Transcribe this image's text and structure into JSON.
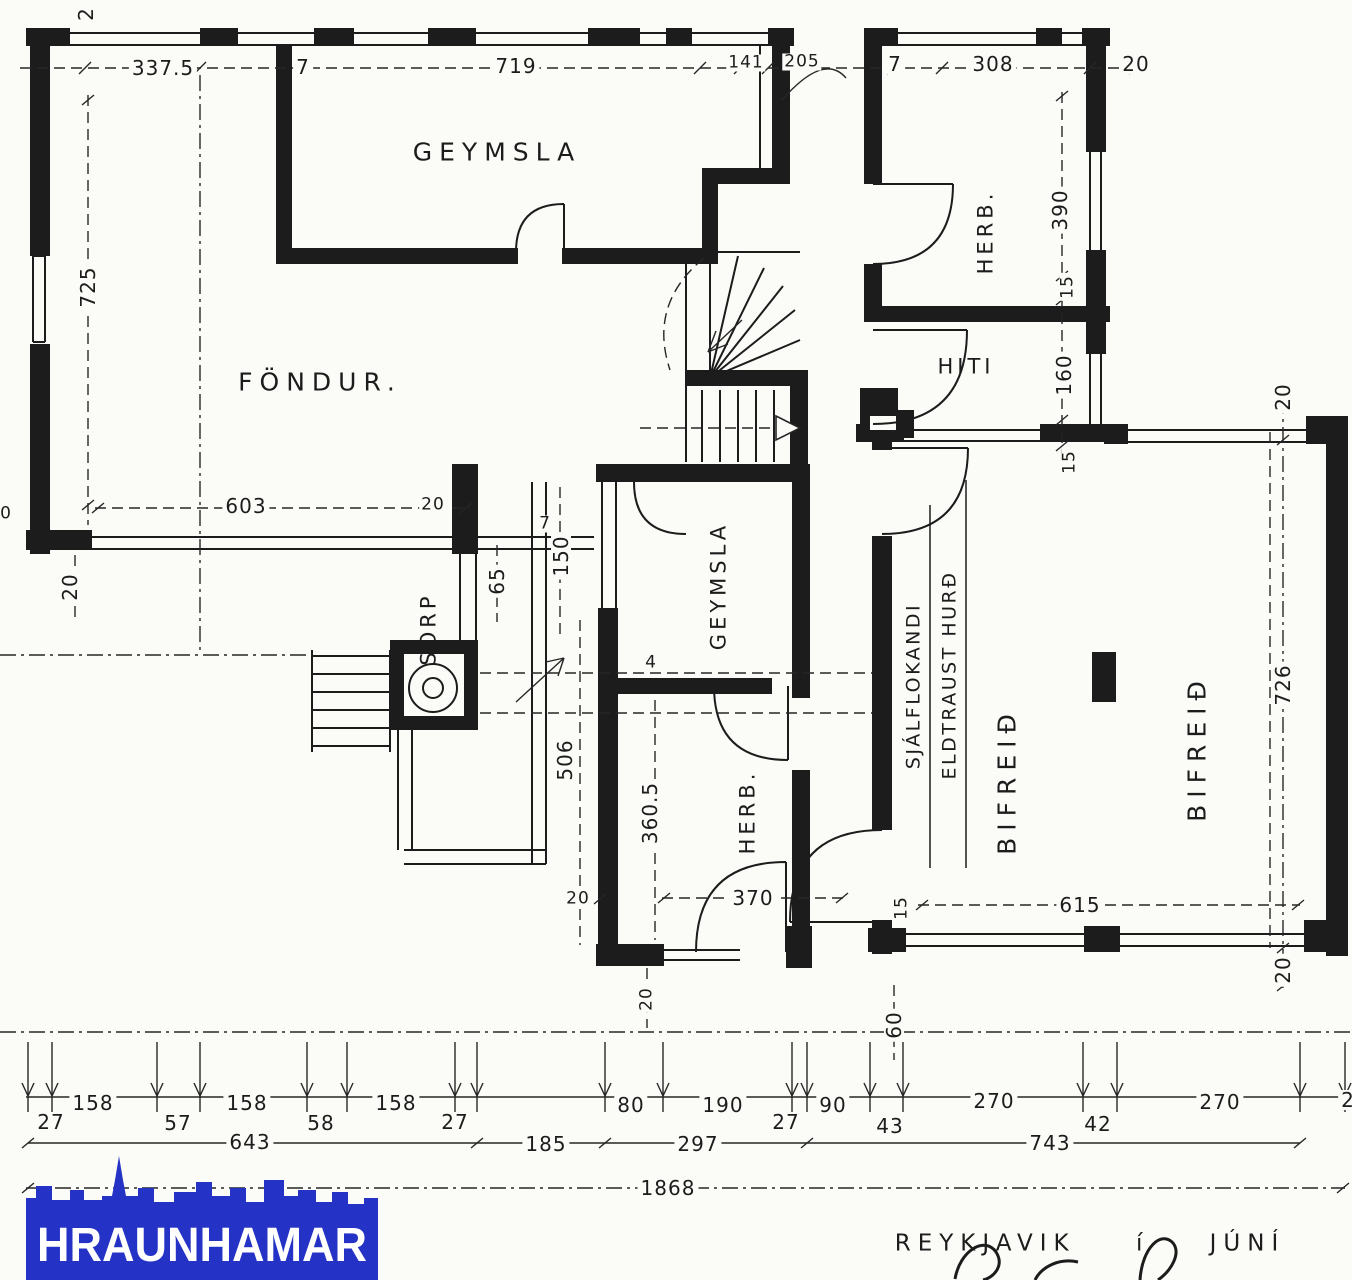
{
  "rooms": {
    "geymsla_top": "GEYMSLA",
    "fondur": "FÖNDUR.",
    "herb_top_right": "HERB.",
    "hiti": "HITI",
    "geymsla_center": "GEYMSLA",
    "herb_center": "HERB.",
    "sorp": "SORP",
    "bifreid_left": "BIFREIÐ",
    "bifreid_right": "BIFREIÐ"
  },
  "notes": {
    "fire_door_line1": "SJÁLFLOKANDI",
    "fire_door_line2": "ELDTRAUST HURÐ"
  },
  "dims": {
    "d0": "0",
    "d2": "2",
    "d4": "4",
    "d7": "7",
    "d15": "15",
    "d20": "20",
    "d27": "27",
    "d42": "42",
    "d43": "43",
    "d57": "57",
    "d58": "58",
    "d60": "60",
    "d65": "65",
    "d80": "80",
    "d90": "90",
    "d141": "141",
    "d150": "150",
    "d158": "158",
    "d160": "160",
    "d185": "185",
    "d190": "190",
    "d205": "205",
    "d270": "270",
    "d297": "297",
    "d308": "308",
    "d337_5": "337.5",
    "d360_5": "360.5",
    "d370": "370",
    "d390": "390",
    "d506": "506",
    "d603": "603",
    "d615": "615",
    "d643": "643",
    "d719": "719",
    "d725": "725",
    "d726": "726",
    "d743": "743",
    "d1868": "1868"
  },
  "footer": {
    "logo_text": "HRAUNHAMAR",
    "place_date": "REYKJAVIK í JÚNÍ"
  },
  "colors": {
    "ink": "#1c1c1c",
    "logo_blue": "#2433c6",
    "logo_text_color": "#ffffff",
    "paper": "#fbfbf8"
  }
}
